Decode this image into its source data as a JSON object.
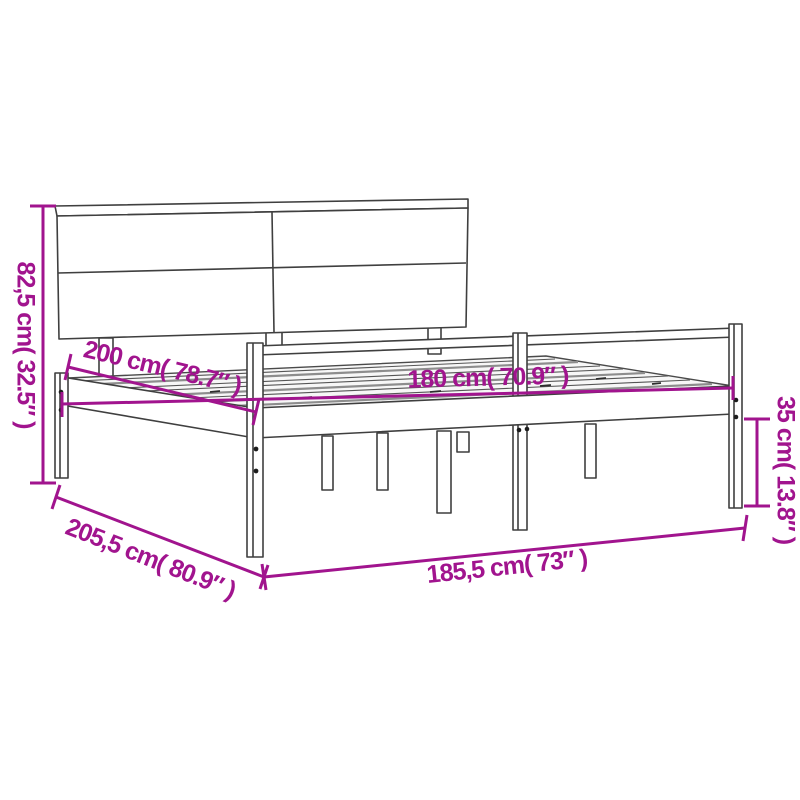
{
  "diagram": {
    "kind": "product-dimension-diagram",
    "subject": "bed-frame-with-headboard",
    "background_color": "#ffffff",
    "drawing_line_color": "#3f3f3f",
    "dimension_color": "#a1148e",
    "dimensions": {
      "headboard_height": {
        "label": "82,5 cm( 32.5″ )",
        "cm": "82,5",
        "inches": "32.5",
        "placement": "vertical-left"
      },
      "mattress_length": {
        "label": "200 cm( 78.7″ )",
        "cm": "200",
        "inches": "78.7",
        "placement": "diagonal-upper-left"
      },
      "mattress_width": {
        "label": "180 cm( 70.9″ )",
        "cm": "180",
        "inches": "70.9",
        "placement": "horizontal-middle"
      },
      "leg_height": {
        "label": "35 cm( 13.8″ )",
        "cm": "35",
        "inches": "13.8",
        "placement": "vertical-right"
      },
      "frame_length": {
        "label": "205,5 cm( 80.9″ )",
        "cm": "205,5",
        "inches": "80.9",
        "placement": "diagonal-lower-left"
      },
      "frame_width": {
        "label": "185,5 cm( 73″ )",
        "cm": "185,5",
        "inches": "73",
        "placement": "horizontal-bottom"
      }
    }
  }
}
